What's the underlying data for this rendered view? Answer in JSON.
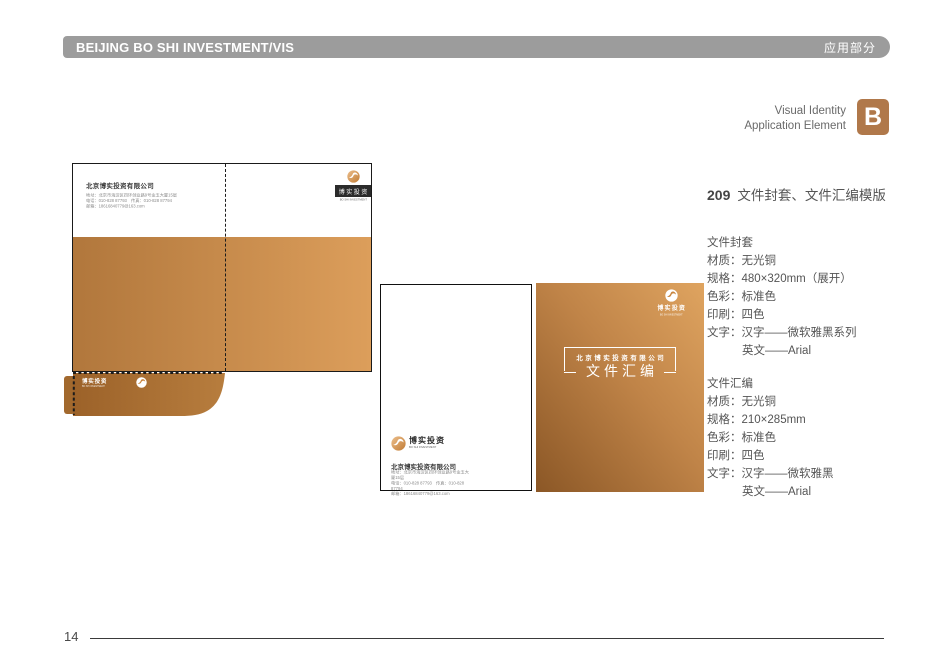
{
  "header": {
    "title": "BEIJING BO SHI INVESTMENT/VIS",
    "tag": "应用部分"
  },
  "corner": {
    "line1": "Visual Identity",
    "line2": "Application Element",
    "badge": "B"
  },
  "section": {
    "number": "209",
    "title": "文件封套、文件汇编模版"
  },
  "specs": [
    {
      "heading": "文件封套",
      "lines": [
        "材质：无光铜",
        "规格：480×320mm（展开）",
        "色彩：标准色",
        "印刷：四色",
        "文字：汉字——微软雅黑系列"
      ],
      "indent_line": "英文——Arial"
    },
    {
      "heading": "文件汇编",
      "lines": [
        "材质：无光铜",
        "规格：210×285mm",
        "色彩：标准色",
        "印刷：四色",
        "文字：汉字——微软雅黑"
      ],
      "indent_line": "英文——Arial"
    }
  ],
  "brand": {
    "logo_cn": "博实投资",
    "logo_en": "BO SHI INVESTMENT",
    "company": "北京博实投资有限公司",
    "address": "地址：北京市海淀区四环创业路9号金玉大厦15层",
    "phone": "电话：010-828 87793　传真：010-828 87794",
    "email": "邮箱：18616840779@163.com"
  },
  "cover": {
    "company": "北京博实投资有限公司",
    "title": "文件汇编"
  },
  "footer": {
    "page_number": "14"
  },
  "colors": {
    "header_bar": "#9c9c9c",
    "badge": "#b0784a",
    "folder_gradient": [
      "#b1773c",
      "#dc9e5b"
    ],
    "pocket_gradient": [
      "#9c6229",
      "#b77d3e"
    ],
    "cover_gradient": [
      "#8b5726",
      "#dfa460"
    ]
  }
}
